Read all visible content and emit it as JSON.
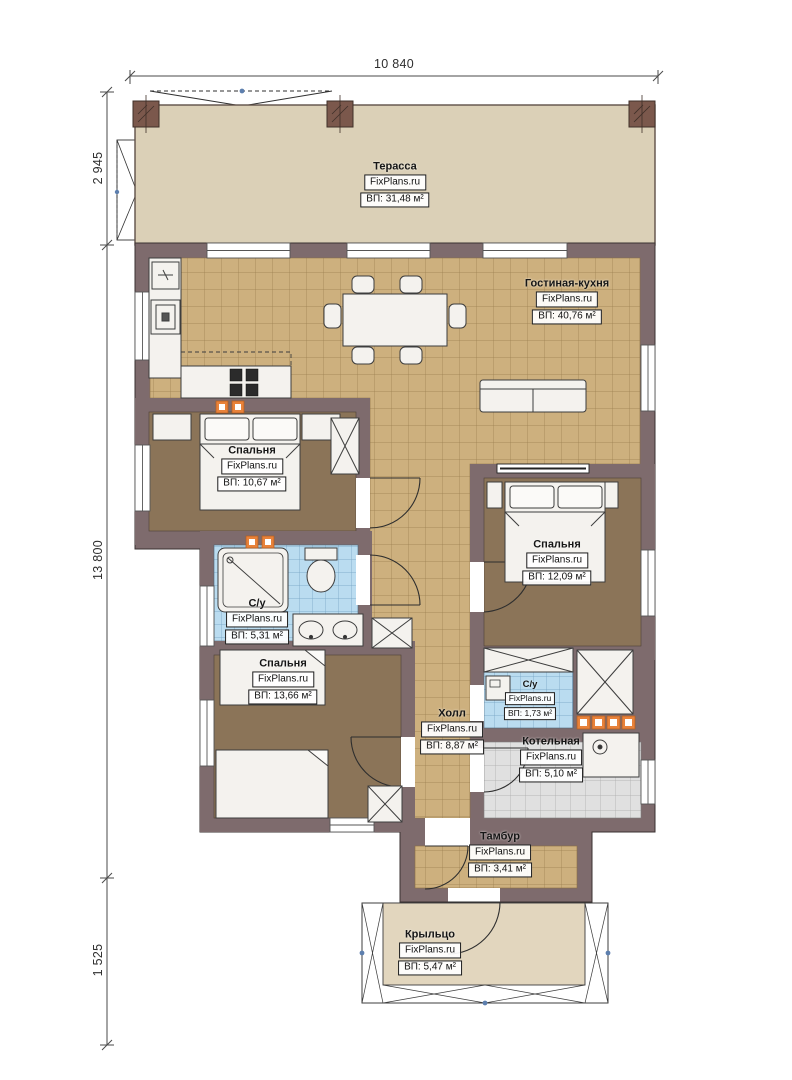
{
  "watermark": "FixPlans.ru",
  "dimensions": {
    "width_top": "10 840",
    "terrace_depth": "2 945",
    "house_depth": "13 800",
    "porch_depth": "1 525"
  },
  "rooms": {
    "terrace": {
      "name": "Терасса",
      "area": "ВП: 31,48 м²"
    },
    "living": {
      "name": "Гостиная-кухня",
      "area": "ВП: 40,76 м²"
    },
    "bedroom1": {
      "name": "Спальня",
      "area": "ВП: 10,67 м²"
    },
    "bathroom1": {
      "name": "С/у",
      "area": "ВП: 5,31 м²"
    },
    "bedroom2": {
      "name": "Спальня",
      "area": "ВП: 12,09 м²"
    },
    "bedroom3": {
      "name": "Спальня",
      "area": "ВП: 13,66 м²"
    },
    "hall": {
      "name": "Холл",
      "area": "ВП: 8,87 м²"
    },
    "bathroom2": {
      "name": "С/у",
      "area": "ВП: 1,73 м²"
    },
    "boiler": {
      "name": "Котельная",
      "area": "ВП: 5,10 м²"
    },
    "vestibule": {
      "name": "Тамбур",
      "area": "ВП: 3,41 м²"
    },
    "porch": {
      "name": "Крыльцо",
      "area": "ВП: 5,47 м²"
    }
  },
  "colors": {
    "wall": "#7e6b6d",
    "column": "#7b584c",
    "terrace_fill": "#dbd0b7",
    "tile_tan": "#cdb07e",
    "tile_blue": "#badcf0",
    "tile_gray": "#e0e0e0",
    "bedroom_floor": "#8b7458",
    "porch_fill": "#e2d6be",
    "radiator": "#e8823a"
  }
}
